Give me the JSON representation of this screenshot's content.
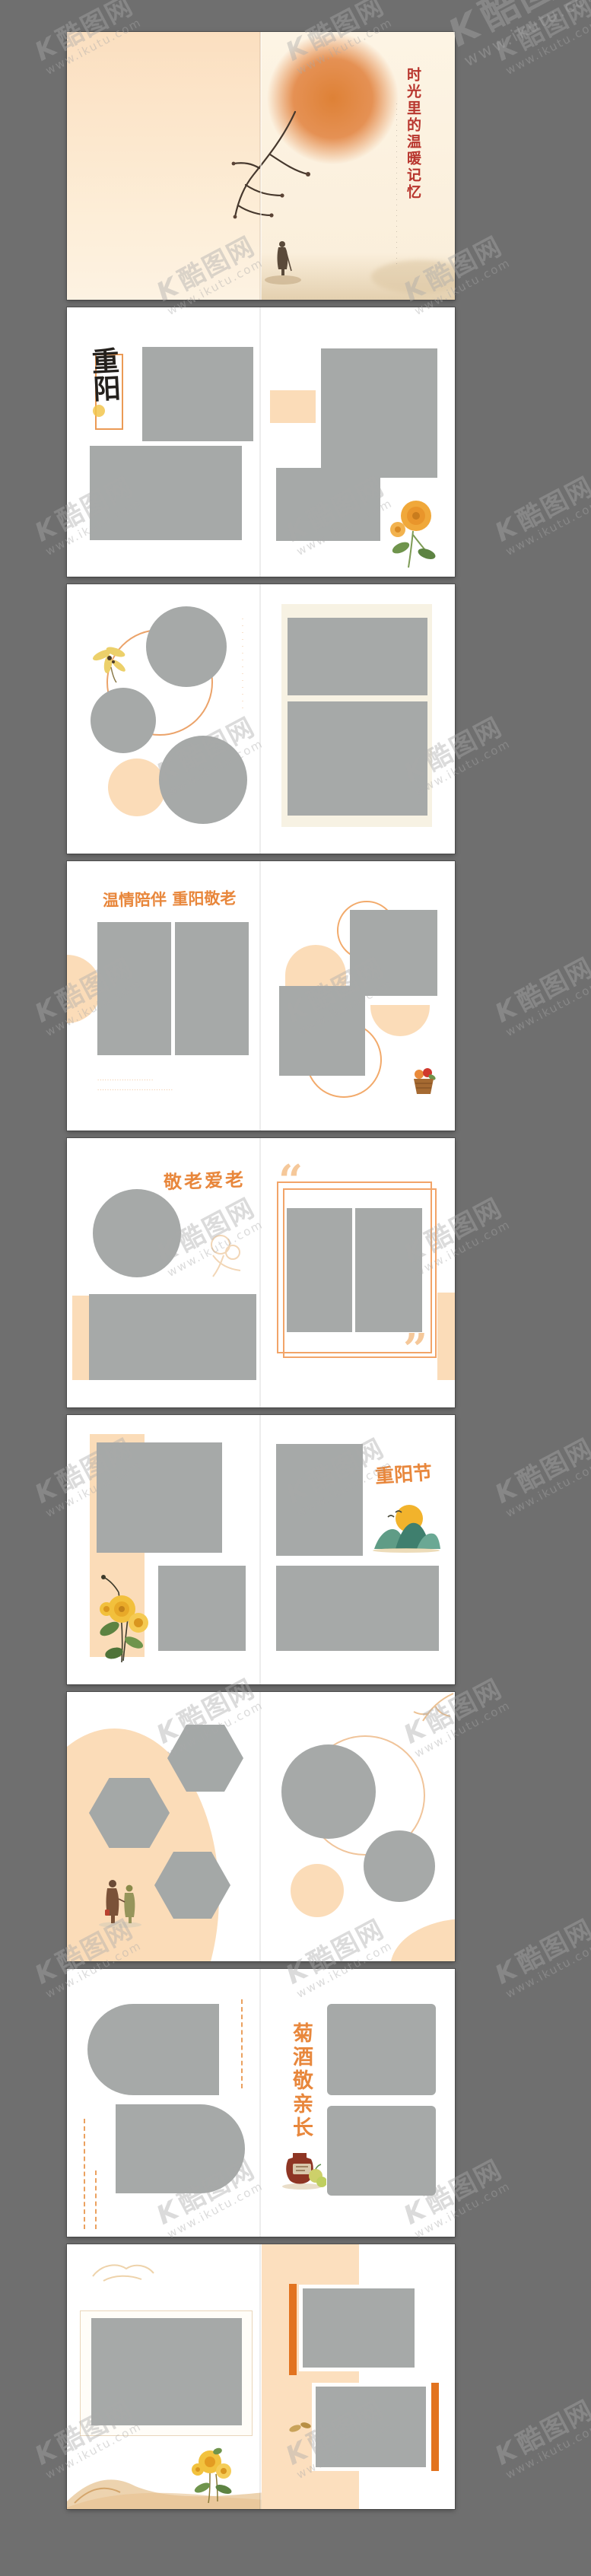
{
  "watermark": {
    "logo": "K",
    "name": "酷图网",
    "url": "www.ikutu.com"
  },
  "colors": {
    "background_gray": "#6f6f6f",
    "page_white": "#ffffff",
    "photo_gray": "#a6a9a8",
    "peach": "#fbdcb8",
    "accent_orange": "#e8873c",
    "bar_orange": "#e2731f",
    "frame_orange": "#f2aa6b",
    "title_red": "#b8352d",
    "cream": "#f7f2e3",
    "sun_orange": "#de8136"
  },
  "cover": {
    "title": "时光里的温暖记忆",
    "subtitle_dots": "·······························"
  },
  "spreads": {
    "s2": {
      "calligraphy": "重阳"
    },
    "s3": {
      "caption_dots": "····················"
    },
    "s4": {
      "heading": "温情陪伴 重阳敬老",
      "caption_line1": "·······················",
      "caption_line2": "·······························"
    },
    "s5": {
      "heading": "敬老爱老",
      "quote_open": "“",
      "quote_close": "”"
    },
    "s6": {
      "heading": "重阳节"
    },
    "s8": {
      "heading_vertical": "菊酒敬亲长"
    }
  }
}
